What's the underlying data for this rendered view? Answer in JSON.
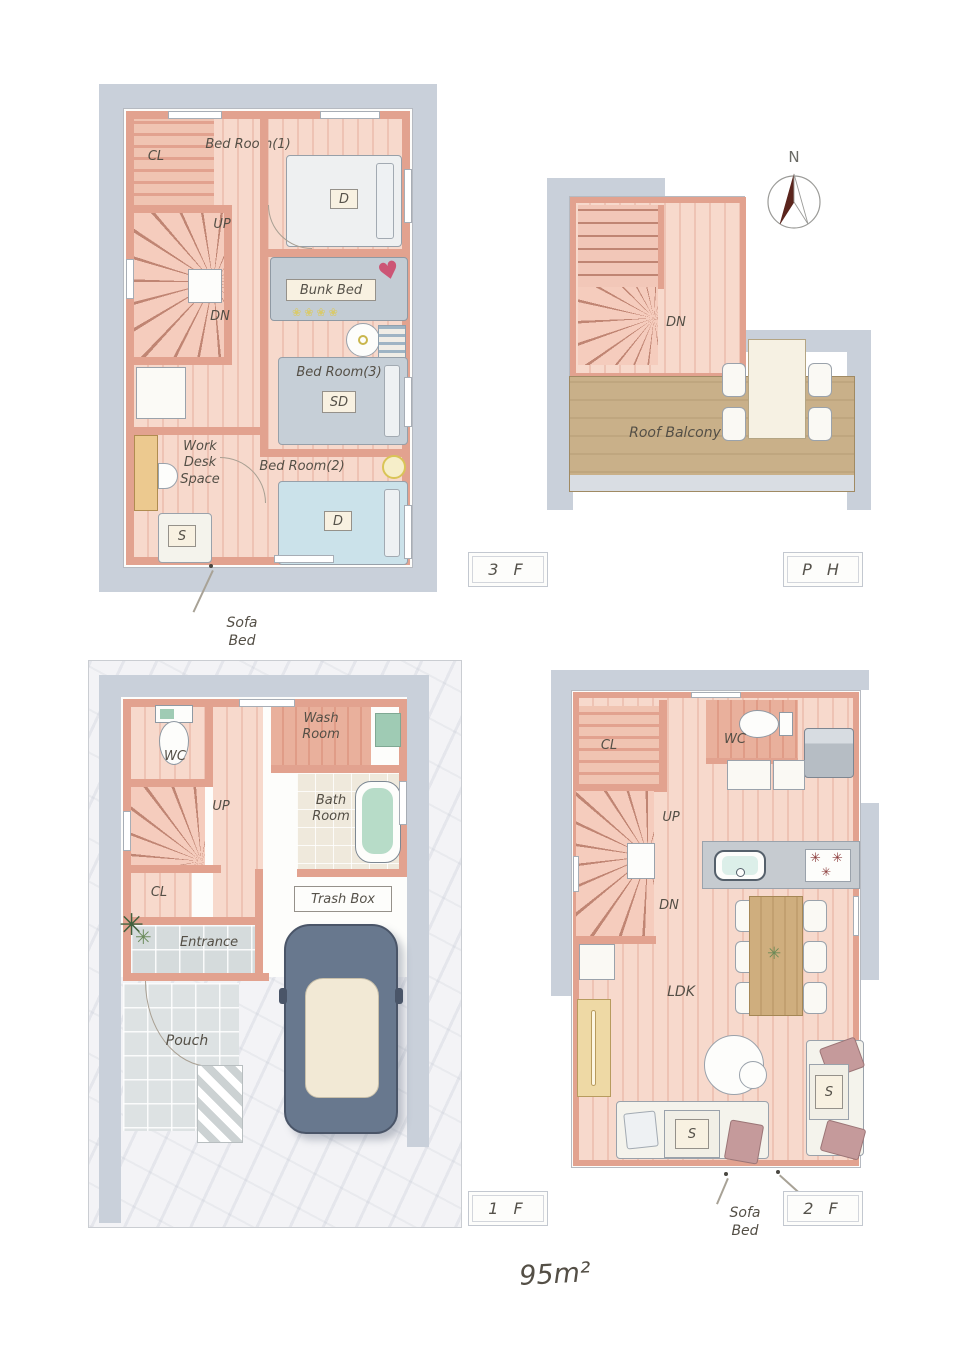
{
  "area_label": "95m²",
  "compass": {
    "north": "N"
  },
  "floor_3f": {
    "tag": "3 F",
    "cl": "CL",
    "bedroom1": "Bed Room(1)",
    "bed1_mark": "D",
    "up": "UP",
    "dn": "DN",
    "bunk_bed": "Bunk Bed",
    "bedroom3": "Bed Room(3)",
    "bed3_mark": "SD",
    "work_desk_space": "Work\nDesk\nSpace",
    "bedroom2": "Bed Room(2)",
    "bed2_mark": "D",
    "sofa_mark": "S",
    "sofa_bed_note": "Sofa\nBed"
  },
  "floor_ph": {
    "tag": "P H",
    "dn": "DN",
    "roof_balcony": "Roof Balcony"
  },
  "floor_1f": {
    "tag": "1 F",
    "wc": "WC",
    "wash_room": "Wash\nRoom",
    "bath_room": "Bath\nRoom",
    "up": "UP",
    "cl": "CL",
    "trash_box": "Trash Box",
    "entrance": "Entrance",
    "pouch": "Pouch"
  },
  "floor_2f": {
    "tag": "2 F",
    "cl": "CL",
    "wc": "WC",
    "up": "UP",
    "dn": "DN",
    "ldk": "LDK",
    "sofa_mark_center": "S",
    "sofa_mark_right": "S",
    "sofa_bed_note": "Sofa\nBed"
  },
  "colors": {
    "wall": "#e2a28f",
    "floor_light": "#f7d9cc",
    "floor_stripe": "#eec3b4",
    "outer_band": "#c9d0da",
    "balcony_floor": "#c9b089",
    "bed_blue": "#cbe2ea",
    "bed_gray": "#c6cfd7",
    "bunk_gray": "#c3ccd4",
    "bath_water": "#b7dcc8",
    "dining_wood": "#c9a878",
    "cabinet_yellow": "#eed9a5",
    "heart_pink": "#cc5575",
    "car_body": "#68788e",
    "car_roof": "#f2e9d5"
  }
}
